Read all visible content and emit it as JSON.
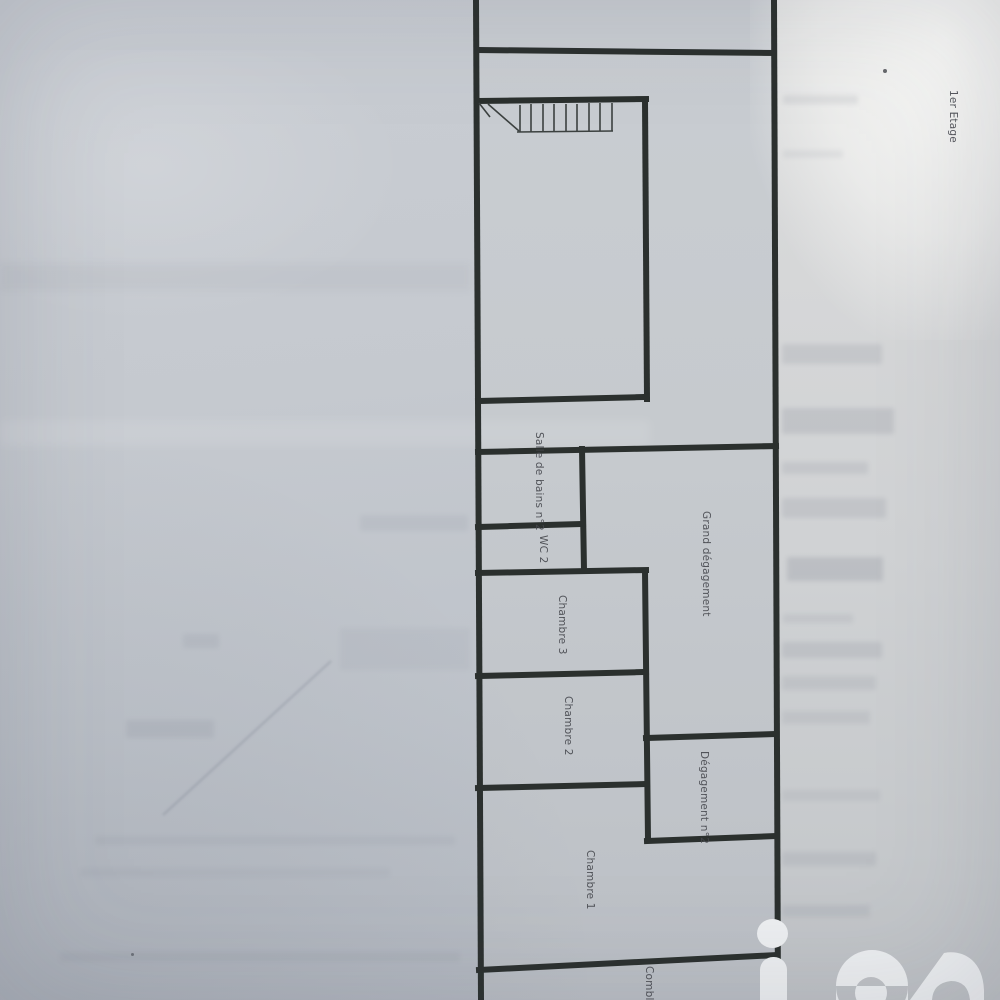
{
  "photo": {
    "floor_title": "1er Etage",
    "rooms": [
      {
        "id": "salle-de-bains-2",
        "label": "Salle de bains n°2"
      },
      {
        "id": "wc-2",
        "label": "WC 2"
      },
      {
        "id": "chambre-3",
        "label": "Chambre 3"
      },
      {
        "id": "chambre-2",
        "label": "Chambre 2"
      },
      {
        "id": "chambre-1",
        "label": "Chambre 1"
      },
      {
        "id": "grand-degagement",
        "label": "Grand dégagement"
      },
      {
        "id": "degagement-2",
        "label": "Dégagement n°2"
      },
      {
        "id": "combles",
        "label": "Combles"
      }
    ],
    "colors": {
      "paper": "#c4c8ce",
      "paper_light": "#e9eaea",
      "wall": "#2b302e",
      "label_text": "#45474d",
      "watermark": "#edeff1"
    }
  },
  "watermark": {
    "brand": "iad"
  }
}
